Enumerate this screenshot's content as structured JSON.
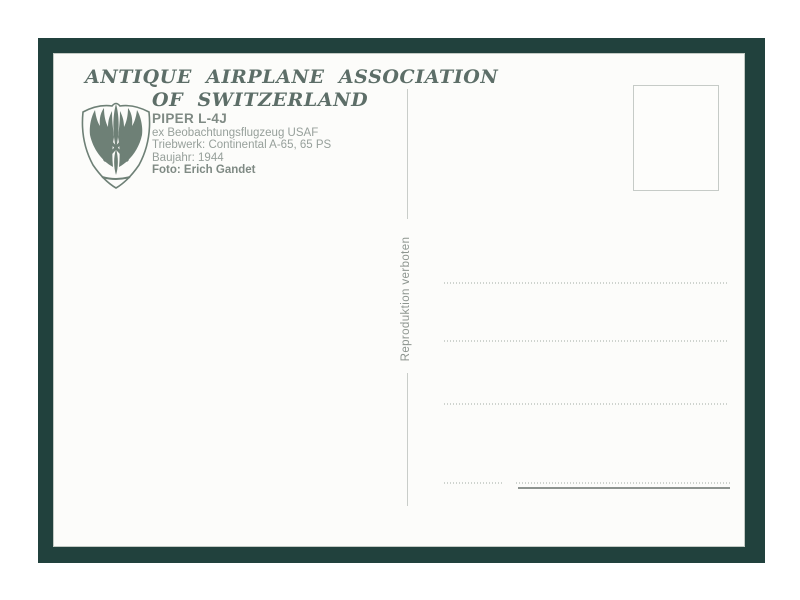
{
  "postcard": {
    "header": {
      "title_line1": "ANTIQUE AIRPLANE ASSOCIATION",
      "title_line2": "OF SWITZERLAND"
    },
    "logo": {
      "icon": "winged-propeller-shield-icon"
    },
    "details": {
      "aircraft_model": "PIPER L-4J",
      "description": "ex Beobachtungsflugzeug USAF",
      "engine": "Triebwerk: Continental A-65, 65 PS",
      "year": "Baujahr: 1944",
      "photo_credit": "Foto: Erich Gandet"
    },
    "divider_note": "Reproduktion verboten",
    "stamp_box": "empty",
    "colors": {
      "frame_green": "#21413d",
      "card_background": "#fcfcfa",
      "title_text": "#5d6e68",
      "detail_text": "#97a09b",
      "detail_text_bold": "#7f8a84",
      "logo_green": "#6e8076",
      "divider_gray": "#c9cdc9",
      "dotted_line_gray": "#ced3ce",
      "solid_line_gray": "#8d938f"
    }
  }
}
